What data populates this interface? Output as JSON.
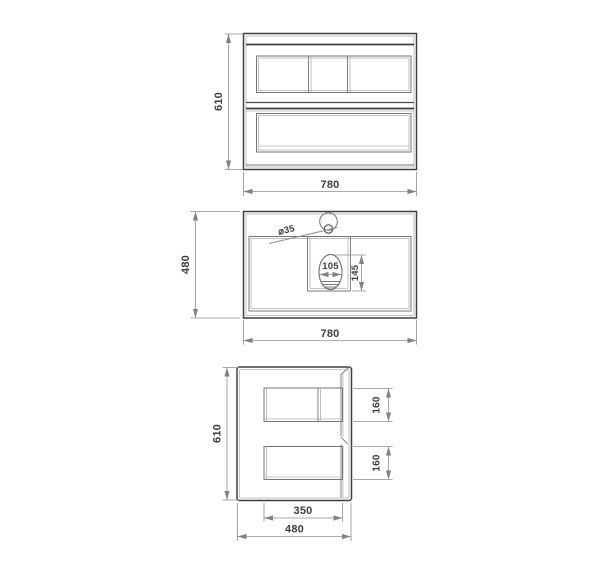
{
  "drawing": {
    "title": "vanity-unit-technical-drawing",
    "front_view": {
      "height_dim": "610",
      "width_dim": "780"
    },
    "top_view": {
      "height_dim": "480",
      "width_dim": "780",
      "faucet_dim": "⌀35",
      "drain_width_dim": "105",
      "drain_depth_dim": "145"
    },
    "side_view": {
      "height_dim": "610",
      "width_dim": "480",
      "inner_width_dim": "350",
      "upper_drawer_dim": "160",
      "lower_drawer_dim": "160"
    },
    "colors": {
      "outline": "#3e3e3e",
      "detail": "#757575",
      "light_detail": "#b2b2b2",
      "dimension": "#8f8f8f",
      "text": "#3c3c3c",
      "background": "#ffffff"
    }
  }
}
